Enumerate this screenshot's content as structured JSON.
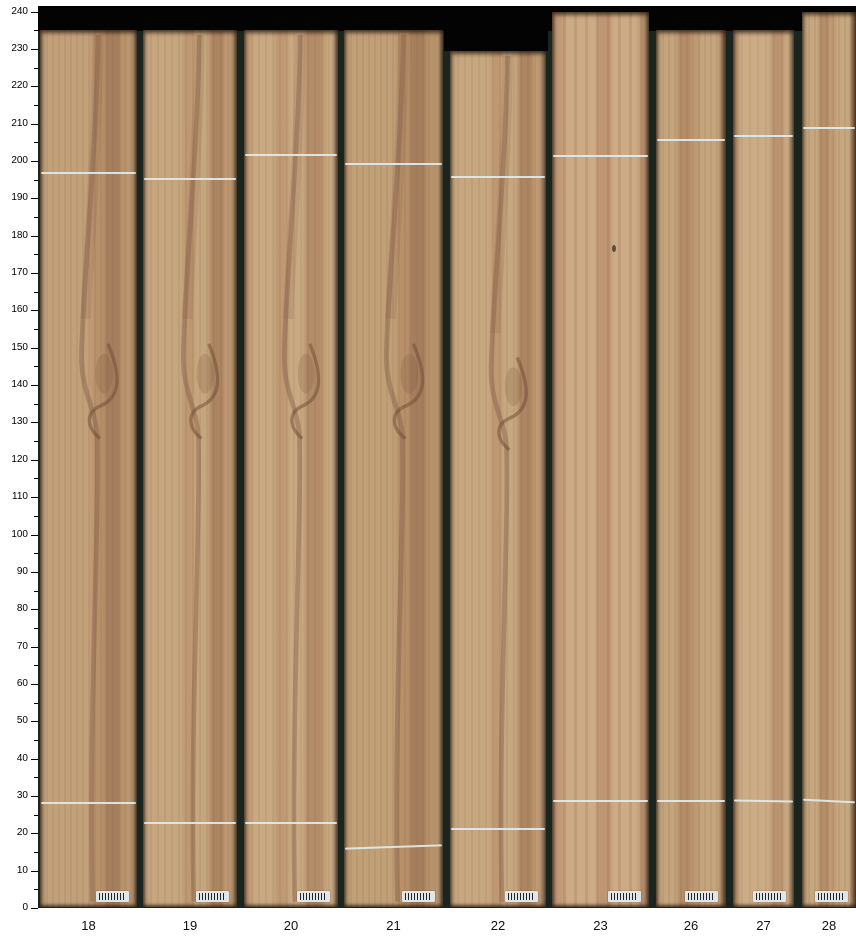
{
  "figure": {
    "page_bg": "#ffffff",
    "plot_bg": "#1b2520",
    "top_band_color": "#030303",
    "chalk_color": "#dfeaec",
    "tick_color": "#000000",
    "label_color": "#111111",
    "barcode_bg": "#e0e5e8",
    "barcode_bar_color": "#20262e"
  },
  "axis": {
    "min": 0,
    "max": 240,
    "major_step": 10,
    "minor_step": 5,
    "tick_labels": [
      "0",
      "10",
      "20",
      "30",
      "40",
      "50",
      "60",
      "70",
      "80",
      "90",
      "100",
      "110",
      "120",
      "130",
      "140",
      "150",
      "160",
      "170",
      "180",
      "190",
      "200",
      "210",
      "220",
      "230",
      "240"
    ]
  },
  "boards": [
    {
      "id": "18",
      "x": 40,
      "w": 97,
      "top": 235,
      "upper_mark": 197,
      "lower_mark": 28.5,
      "lower_tilt": 0,
      "knot": true,
      "barcode": true,
      "tex": "A",
      "base": "#c2a17a"
    },
    {
      "id": "19",
      "x": 143,
      "w": 94,
      "top": 235,
      "upper_mark": 195.5,
      "lower_mark": 23,
      "lower_tilt": 0,
      "knot": true,
      "barcode": true,
      "tex": "B",
      "base": "#c6a67e"
    },
    {
      "id": "20",
      "x": 244,
      "w": 94,
      "top": 235,
      "upper_mark": 202,
      "lower_mark": 23,
      "lower_tilt": 0,
      "knot": true,
      "barcode": true,
      "tex": "C",
      "base": "#c9a982"
    },
    {
      "id": "21",
      "x": 344,
      "w": 99,
      "top": 235,
      "upper_mark": 199.5,
      "lower_mark": 16.5,
      "lower_tilt": -2,
      "knot": true,
      "barcode": true,
      "tex": "A",
      "base": "#c1a078"
    },
    {
      "id": "22",
      "x": 450,
      "w": 96,
      "top": 229.5,
      "upper_mark": 196,
      "lower_mark": 21.5,
      "lower_tilt": 0,
      "knot": true,
      "barcode": true,
      "tex": "B",
      "base": "#c7a77f"
    },
    {
      "id": "23",
      "x": 552,
      "w": 97,
      "top": 240,
      "upper_mark": 201.5,
      "lower_mark": 29,
      "lower_tilt": 0,
      "knot": false,
      "speck": 177.5,
      "barcode": true,
      "tex": "D",
      "base": "#ccab86"
    },
    {
      "id": "26",
      "x": 656,
      "w": 70,
      "top": 235,
      "upper_mark": 206,
      "lower_mark": 29,
      "lower_tilt": 0,
      "knot": false,
      "barcode": true,
      "tex": "E",
      "base": "#c5a57d"
    },
    {
      "id": "27",
      "x": 733,
      "w": 61,
      "top": 235,
      "upper_mark": 207,
      "lower_mark": 29,
      "lower_tilt": 1,
      "knot": false,
      "barcode": true,
      "tex": "F",
      "base": "#cbac86"
    },
    {
      "id": "28",
      "x": 802,
      "w": 54,
      "top": 240,
      "upper_mark": 209,
      "lower_mark": 29,
      "lower_tilt": 3,
      "knot": false,
      "barcode": true,
      "tex": "E",
      "base": "#c6a77f"
    }
  ],
  "chart_data": {
    "type": "bar",
    "title": "",
    "xlabel": "board id",
    "ylabel": "position scale",
    "ylim": [
      0,
      240
    ],
    "grid": false,
    "legend": false,
    "categories": [
      "18",
      "19",
      "20",
      "21",
      "22",
      "23",
      "26",
      "27",
      "28"
    ],
    "series": [
      {
        "name": "board top (scale units)",
        "values": [
          235,
          235,
          235,
          235,
          229.5,
          240,
          235,
          235,
          240
        ]
      },
      {
        "name": "upper chalk mark",
        "values": [
          197,
          195.5,
          202,
          199.5,
          196,
          201.5,
          206,
          207,
          209
        ]
      },
      {
        "name": "lower chalk mark",
        "values": [
          28.5,
          23,
          23,
          16.5,
          21.5,
          29,
          29,
          29,
          29
        ]
      }
    ]
  }
}
